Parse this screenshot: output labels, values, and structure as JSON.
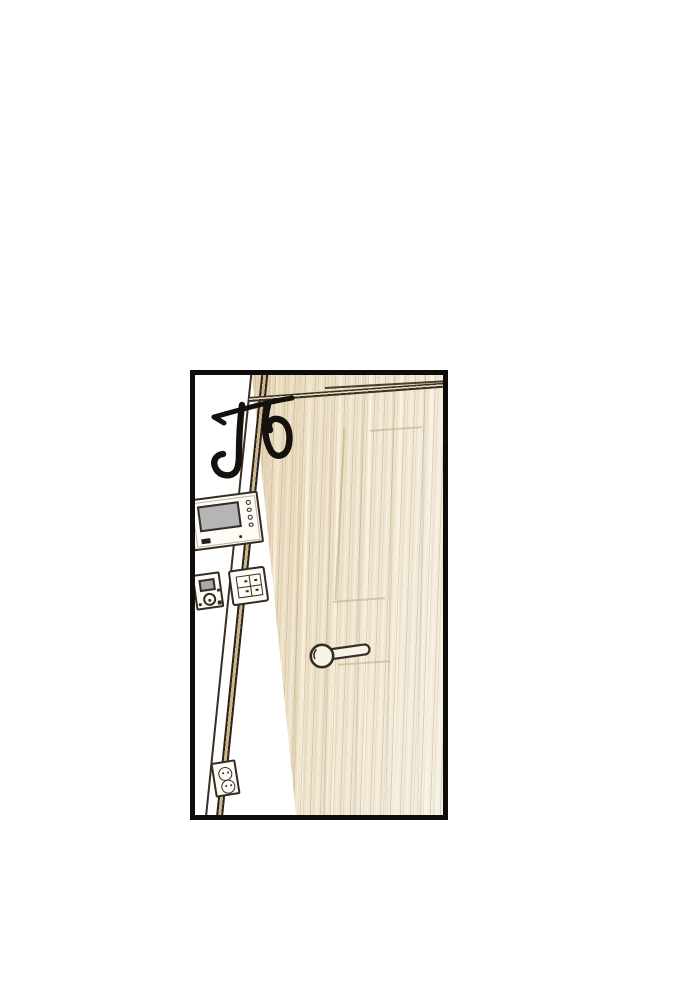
{
  "page": {
    "background_color": "#ffffff"
  },
  "panel": {
    "border_color": "#0f0d0b",
    "wall_color": "#ffffff",
    "sfx": {
      "text": "ปัง",
      "color": "#15110d"
    },
    "door": {
      "wood_base_color": "#ecdfc4",
      "wood_shadow_color": "#d8c5a0",
      "wood_highlight_color": "#f5efe1",
      "edge_line_color": "#2e2318",
      "handle_color": "#f7f3e9",
      "outline_color": "#372e24"
    },
    "wall_devices": [
      {
        "name": "video-intercom",
        "screen_color": "#b5b5b5",
        "button_count": 4
      },
      {
        "name": "control-keypad",
        "screen_color": "#a8a8a8",
        "dial_count": 1
      },
      {
        "name": "light-switch-panel",
        "rocker_rows": 2,
        "rocker_columns": 2
      },
      {
        "name": "power-outlet",
        "socket_count": 2
      }
    ]
  }
}
